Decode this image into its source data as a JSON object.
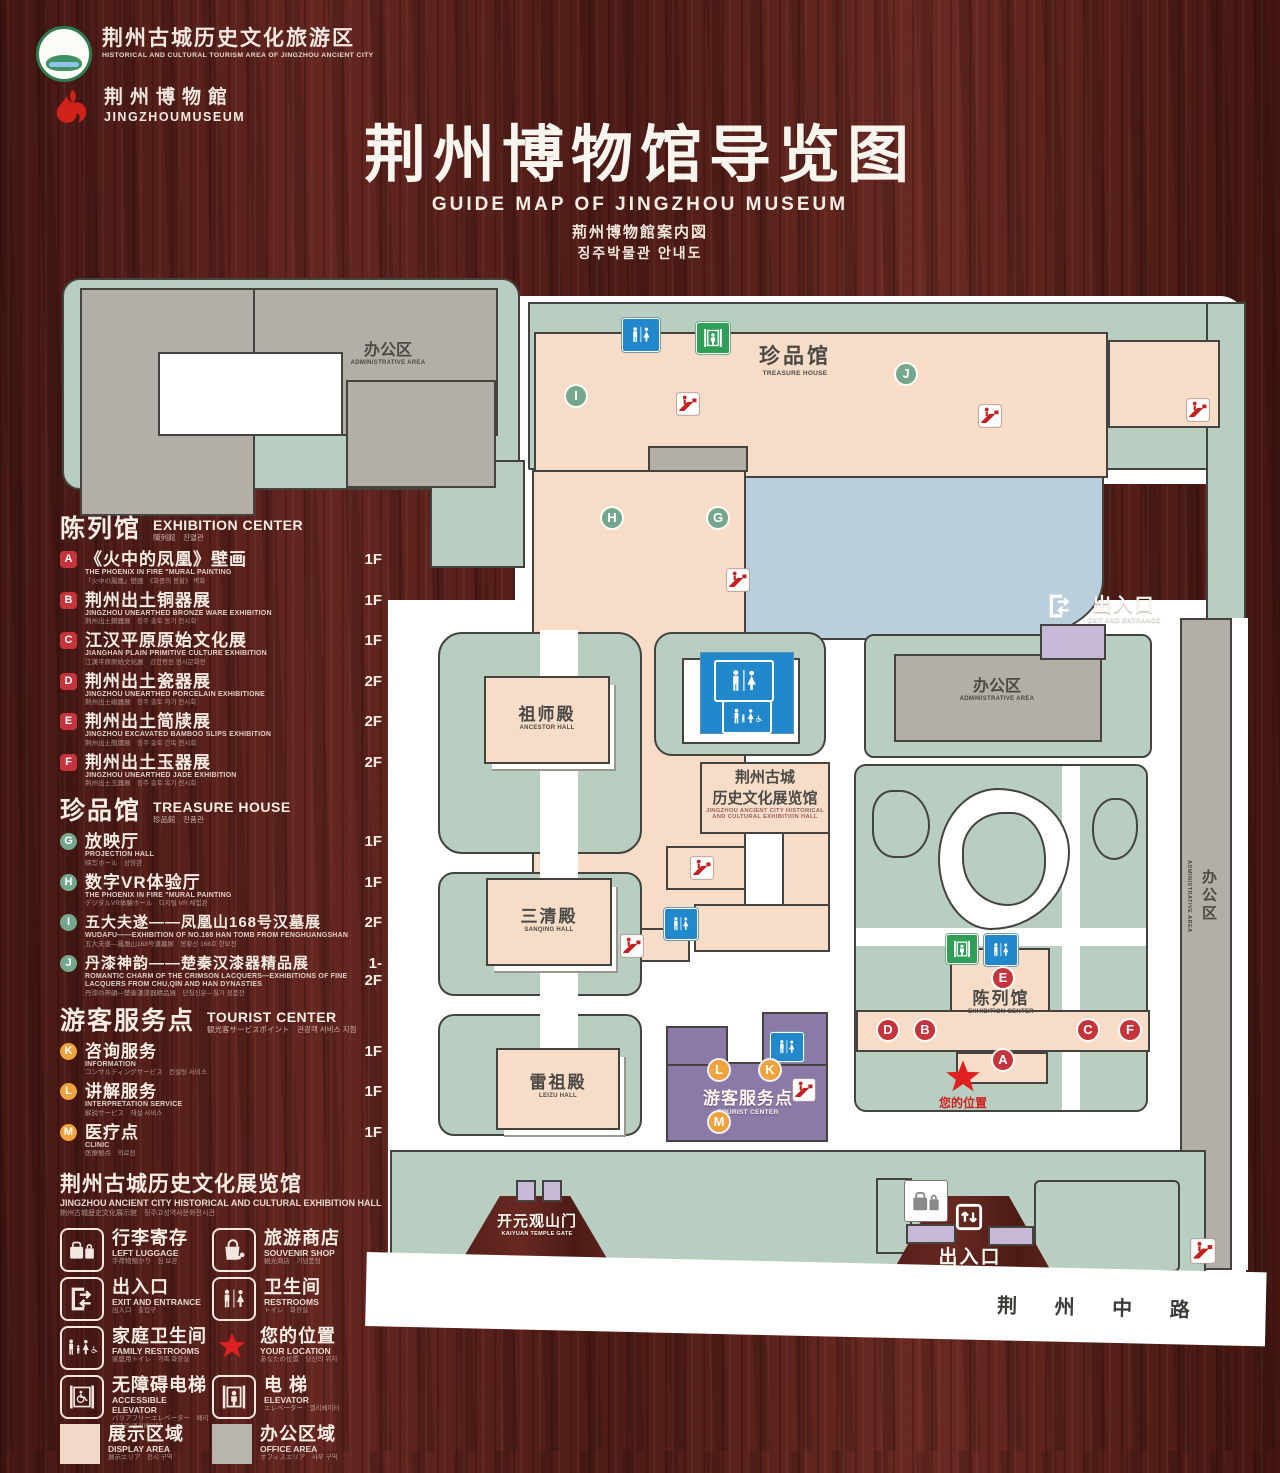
{
  "header": {
    "logo1_cn": "荆州古城历史文化旅游区",
    "logo1_en": "HISTORICAL AND CULTURAL TOURISM AREA OF JINGZHOU ANCIENT CITY",
    "logo2_cn": "荆州博物館",
    "logo2_en": "JINGZHOUMUSEUM",
    "title_cn": "荆州博物馆导览图",
    "title_en": "GUIDE MAP OF JINGZHOU MUSEUM",
    "title_jp": "荊州博物館案内図",
    "title_kr": "징주박물관 안내도"
  },
  "legend": {
    "sections": [
      {
        "title_cn": "陈列馆",
        "title_en": "EXHIBITION CENTER",
        "subtitle": "陳列館　진열관",
        "items": [
          {
            "letter": "A",
            "cn": "《火中的凤凰》壁画",
            "en": "THE PHOENIX IN FIRE \"MURAL PAINTING",
            "sub": "「火中の鳳凰」壁画　《화중의 봉황》 벽화",
            "floor": "1F"
          },
          {
            "letter": "B",
            "cn": "荆州出土铜器展",
            "en": "JINGZHOU UNEARTHED BRONZE WARE EXHIBITION",
            "sub": "荆州出土銅器展　징주 출토 동기 전시회",
            "floor": "1F"
          },
          {
            "letter": "C",
            "cn": "江汉平原原始文化展",
            "en": "JIANGHAN PLAIN PRIMITIVE CULTURE EXHIBITION",
            "sub": "江漢平原原始文化展　강한평원 원시문화전",
            "floor": "1F"
          },
          {
            "letter": "D",
            "cn": "荆州出土瓷器展",
            "en": "JINGZHOU UNEARTHED PORCELAIN EXHIBITIONE",
            "sub": "荆州出土磁器展　징주 출토 자기 전시회",
            "floor": "2F"
          },
          {
            "letter": "E",
            "cn": "荆州出土简牍展",
            "en": "JINGZHOU EXCAVATED BAMBOO SLIPS EXHIBITION",
            "sub": "荆州出土簡牘展　징주 출토 간독 전시회",
            "floor": "2F"
          },
          {
            "letter": "F",
            "cn": "荆州出土玉器展",
            "en": "JINGZHOU UNEARTHED JADE EXHIBITION",
            "sub": "荆州出土玉器展　징주 출토 옥기 전시회",
            "floor": "2F"
          }
        ]
      },
      {
        "title_cn": "珍品馆",
        "title_en": "TREASURE HOUSE",
        "subtitle": "珍品館　진품관",
        "items": [
          {
            "letter": "G",
            "cn": "放映厅",
            "en": "PROJECTION HALL",
            "sub": "映写ホール　상영관",
            "floor": "1F"
          },
          {
            "letter": "H",
            "cn": "数字VR体验厅",
            "en": "THE PHOENIX IN FIRE \"MURAL PAINTING",
            "sub": "デジタルVR体験ホール　디지털 VR 체험관",
            "floor": "1F"
          },
          {
            "letter": "I",
            "cn": "五大夫遂——凤凰山168号汉墓展",
            "en": "WUDAFU——EXHIBITION OF NO.168 HAN TOMB FROM FENGHUANGSHAN",
            "sub": "五大夫遂—鳳凰山168号漢墓展　봉황산 168호 한묘전",
            "floor": "2F"
          },
          {
            "letter": "J",
            "cn": "丹漆神韵——楚秦汉漆器精品展",
            "en": "ROMANTIC CHARM OF THE CRIMSON LACQUERS—EXHIBITIONS OF FINE LACQUERS FROM CHU,QIN AND HAN DYNASTIES",
            "sub": "丹漆の神韻—楚秦漢漆器精品展　단칠신운—칠기 정품전",
            "floor": "1-2F"
          }
        ]
      },
      {
        "title_cn": "游客服务点",
        "title_en": "TOURIST CENTER",
        "subtitle": "観光客サービスポイント　관광객 서비스 지점",
        "items": [
          {
            "letter": "K",
            "cn": "咨询服务",
            "en": "INFORMATION",
            "sub": "コンサルティングサービス　컨설팅 서비스",
            "floor": "1F"
          },
          {
            "letter": "L",
            "cn": "讲解服务",
            "en": "INTERPRETATION SERVICE",
            "sub": "解説サービス　해설 서비스",
            "floor": "1F"
          },
          {
            "letter": "M",
            "cn": "医疗点",
            "en": "CLINIC",
            "sub": "医療拠点　의료점",
            "floor": "1F"
          }
        ]
      }
    ],
    "note": {
      "cn": "荆州古城历史文化展览馆",
      "en": "JINGZHOU ANCIENT CITY HISTORICAL AND CULTURAL EXHIBITION HALL",
      "sub": "荆州古城歴史文化展示館　징주고성역사문화전시관"
    },
    "icons": [
      {
        "cn": "行李寄存",
        "en": "LEFT LUGGAGE",
        "sub": "手荷物預かり　짐 보관"
      },
      {
        "cn": "旅游商店",
        "en": "SOUVENIR SHOP",
        "sub": "観光商店　기념품점"
      },
      {
        "cn": "出入口",
        "en": "EXIT AND ENTRANCE",
        "sub": "出入口　출입구"
      },
      {
        "cn": "卫生间",
        "en": "RESTROOMS",
        "sub": "トイレ　화장실"
      },
      {
        "cn": "家庭卫生间",
        "en": "FAMILY RESTROOMS",
        "sub": "家庭用トイレ　가족 화장실"
      },
      {
        "cn": "您的位置",
        "en": "YOUR LOCATION",
        "sub": "あなたの位置　당신의 위치"
      },
      {
        "cn": "无障碍电梯",
        "en": "ACCESSIBLE ELEVATOR",
        "sub": "バリアフリーエレベーター　배리어프리 엘리베이터"
      },
      {
        "cn": "电 梯",
        "en": "ELEVATOR",
        "sub": "エレベーター　엘리베이터"
      },
      {
        "cn": "展示区域",
        "en": "DISPLAY AREA",
        "sub": "展示エリア　전시 구역"
      },
      {
        "cn": "办公区域",
        "en": "OFFICE AREA",
        "sub": "オフィスエリア　사무 구역"
      }
    ]
  },
  "map": {
    "admin_top": {
      "cn": "办公区",
      "en": "ADMINISTRATIVE AREA"
    },
    "treasure": {
      "cn": "珍品馆",
      "en": "TREASURE HOUSE"
    },
    "exit_top": {
      "cn": "出入口",
      "en": "EXIT AND ENTRANCE"
    },
    "admin_mid": {
      "cn": "办公区",
      "en": "ADMINISTRATIVE AREA"
    },
    "admin_right": {
      "cn": "办公区",
      "en": "ADMINISTRATIVE AREA"
    },
    "ancestor": {
      "cn": "祖师殿",
      "en": "ANCESTOR HALL"
    },
    "sanqing": {
      "cn": "三清殿",
      "en": "SANQING HALL"
    },
    "leizu": {
      "cn": "雷祖殿",
      "en": "LEIZU HALL"
    },
    "jz_hall": {
      "cn1": "荆州古城",
      "cn2": "历史文化展览馆",
      "en1": "JINGZHOU ANCIENT CITY HISTORICAL",
      "en2": "AND CULTURAL EXHIBITION HALL"
    },
    "exhibition": {
      "cn": "陈列馆",
      "en": "EXHIBITION CENTER"
    },
    "tourist": {
      "cn": "游客服务点",
      "en": "TOURIST CENTER"
    },
    "your_loc": {
      "cn": "您的位置"
    },
    "gate": {
      "cn": "开元观山门",
      "en": "KAIYUAN TEMPLE GATE"
    },
    "exit_bottom": {
      "cn": "出入口",
      "en": "EXIT AND ENTRANCE"
    },
    "road": {
      "cn": "荆 州 中 路"
    },
    "markers": {
      "a": "A",
      "b": "B",
      "c": "C",
      "d": "D",
      "e": "E",
      "f": "F",
      "g": "G",
      "h": "H",
      "i": "I",
      "j": "J",
      "k": "K",
      "l": "L",
      "m": "M"
    }
  },
  "colors": {
    "wood": "#57201a",
    "display_area": "#f7dcc7",
    "office_area": "#b3afa6",
    "grounds_green": "#b7cec0",
    "lake": "#b9cfdb",
    "tourist_purple": "#8b7aa8",
    "marker_red": "#c5333b",
    "marker_green": "#74a78c",
    "marker_orange": "#f0a33c",
    "wc_blue": "#2288cc",
    "elevator_green": "#2f9e57",
    "star_red": "#e02020"
  }
}
